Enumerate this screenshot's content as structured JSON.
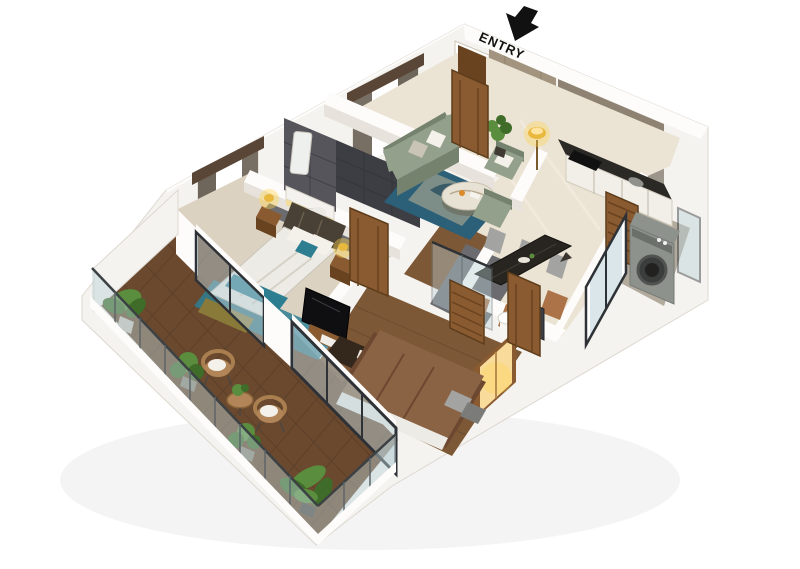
{
  "entry": {
    "label": "ENTRY",
    "arrow_icon": "entry-down-arrow"
  },
  "palette": {
    "wall": "#f5f3ef",
    "wallshade": "#e7e3dc",
    "rim": "#fdfcfa",
    "marble": "#ebe3d3",
    "marblelight": "#f5efe2",
    "graytile": "#b2aa9d",
    "slate": "#55555b",
    "slatedark": "#3d3d44",
    "stone": "#a2947e",
    "stonedark": "#87785f",
    "woodfloor": "#7d5836",
    "wooddark": "#5c4128",
    "deck": "#6a492f",
    "masterfloor": "#dcd2c1",
    "bathfloor": "#6b6b70",
    "sofa": "#93a08c",
    "sofadark": "#75826d",
    "rug": "#2c5f78",
    "ruglight": "#cdbd9a",
    "bedding": "#edebe5",
    "beddingshade": "#d6d2c8",
    "teal": "#2e7e92",
    "headboard": "#4a4136",
    "wooddoor": "#8a5a30",
    "wooddoordark": "#69431f",
    "frame": "#2e3236",
    "glass": "#bcd2d8",
    "counter": "#2b2926",
    "cabinet": "#f2efe8",
    "taupe": "#8e8373",
    "machine": "#8e928d",
    "machinedark": "#5e625c",
    "gold": "#c2953e",
    "glow": "#ffd54a",
    "warm": "#ffe3a1",
    "plant": "#5a8d3d",
    "plantdark": "#3f6c29",
    "wicker": "#b18557",
    "cushion": "#f4f1ea",
    "bed2brown": "#8a6244",
    "bed2dark": "#6d4830",
    "chairgray": "#a3a3a1",
    "chairtan": "#ad7348",
    "tabledark": "#282520",
    "tvblack": "#0f0f12",
    "olive": "#8a7a3a",
    "inkblack": "#111111"
  }
}
